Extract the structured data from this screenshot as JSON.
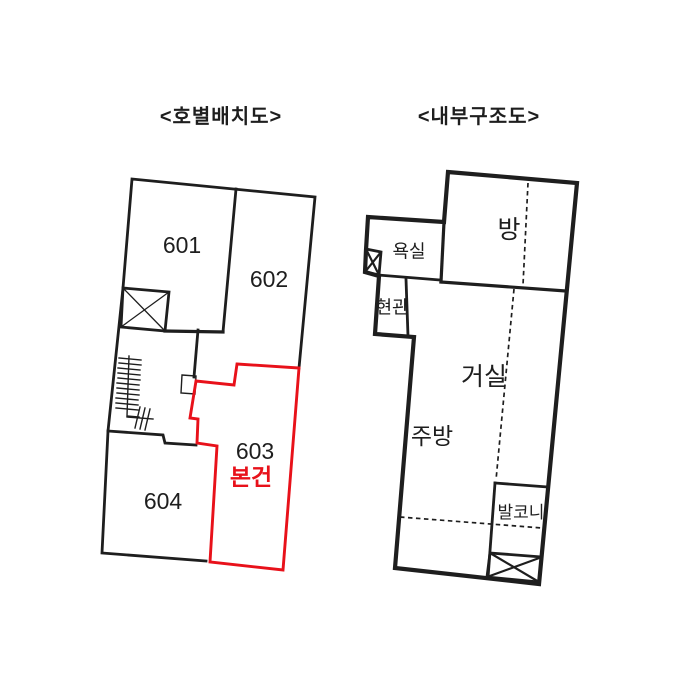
{
  "colors": {
    "line": "#1e1e1e",
    "highlight": "#e8111a",
    "background": "#ffffff"
  },
  "left_diagram": {
    "title": "<호별배치도>",
    "units": [
      {
        "number": "601"
      },
      {
        "number": "602"
      },
      {
        "number": "603",
        "note": "본건"
      },
      {
        "number": "604"
      }
    ]
  },
  "right_diagram": {
    "title": "<내부구조도>",
    "rooms": {
      "bedroom": "방",
      "bathroom": "욕실",
      "entrance": "현관",
      "living_room": "거실",
      "kitchen": "주방",
      "balcony": "발코니"
    }
  }
}
